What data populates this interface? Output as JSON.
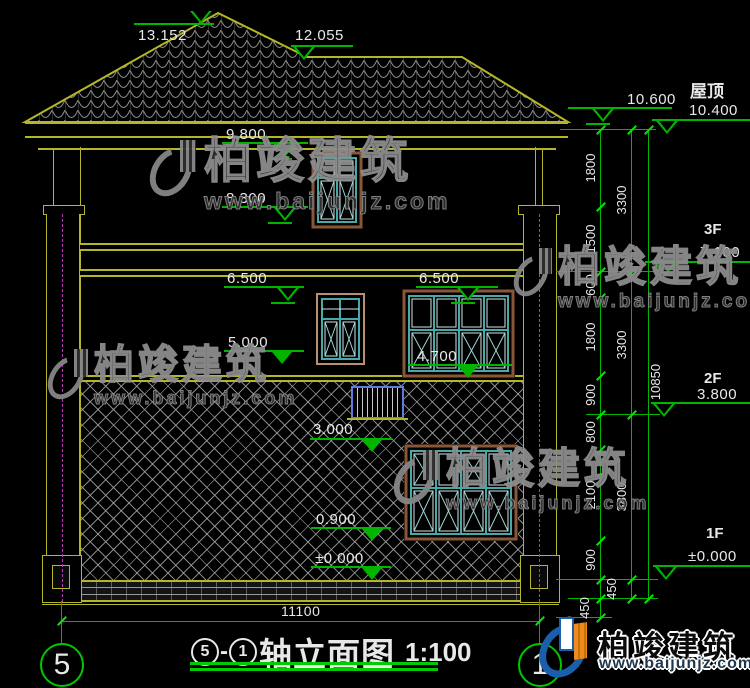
{
  "drawing": {
    "type": "elevation",
    "floor_labels": {
      "roof": "屋顶",
      "f3": "3F",
      "f2": "2F",
      "f1": "1F"
    },
    "levels": {
      "l13152": "13.152",
      "l12055": "12.055",
      "l9800": "9.800",
      "l8300": "8.300",
      "l6500a": "6.500",
      "l6500b": "6.500",
      "l5000": "5.000",
      "l4700": "4.700",
      "l3000": "3.000",
      "l0900": "0.900",
      "l0000": "±0.000",
      "l10600": "10.600",
      "l10400": "10.400",
      "l7100": "7.100",
      "l3800": "3.800",
      "l0000r": "±0.000"
    },
    "dims": {
      "chain_inner": [
        "1800",
        "1500",
        "600",
        "1800",
        "900",
        "800",
        "2100",
        "900"
      ],
      "chain_inner_below": [
        "450",
        "450"
      ],
      "chain_outer": [
        "3300",
        "3300",
        "3800"
      ],
      "chain_outer_below": [
        "450"
      ],
      "total_height": "10850",
      "total_width": "11100"
    },
    "title": {
      "axis_start": "5",
      "sep": "-",
      "axis_end": "1",
      "name": "轴立面图",
      "scale": "1:100"
    },
    "axis_bubbles": {
      "left": "5",
      "right": "1"
    }
  },
  "watermark": {
    "brand": "柏竣建筑",
    "url": "www.baijunjz.com"
  },
  "colors": {
    "background": "#000000",
    "cad_yellow": "#b5b52a",
    "dim_green": "#00b400",
    "bright_green": "#00e800",
    "text_white": "#e8e8e8",
    "window_cyan": "#49a8a8",
    "frame_brown": "#8a5638",
    "railing_blue": "#5d7ce0",
    "centerline_magenta": "#b736b7",
    "logo_blue": "#1a5fae",
    "logo_orange": "#ef8b1d"
  }
}
